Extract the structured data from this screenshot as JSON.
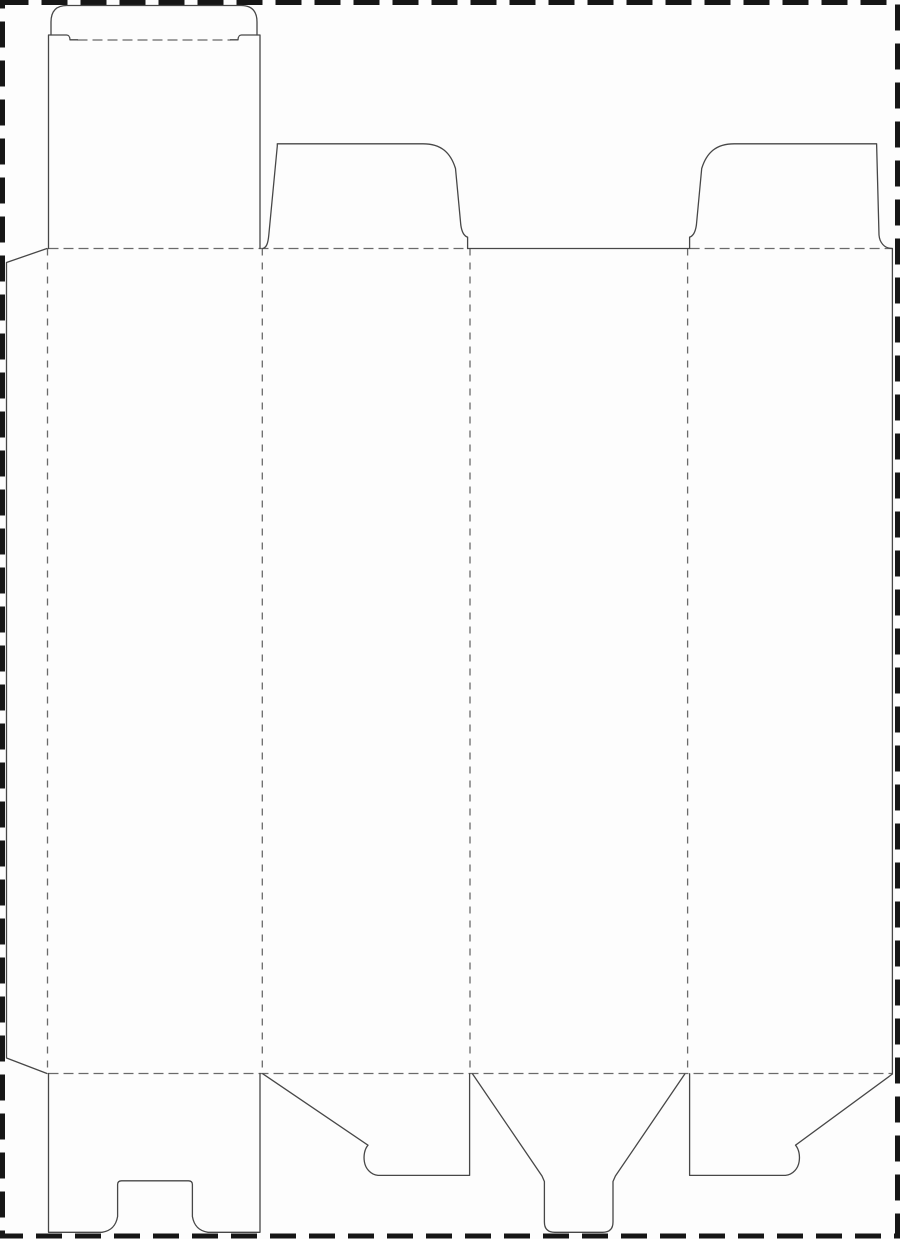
{
  "canvas": {
    "background": "#fdfdfd"
  },
  "colors": {
    "cut_line": "#474747",
    "fold_line": "#6a6a6a",
    "page_border": "#161616",
    "panel_fill": "#fdfdfd"
  },
  "dieline": {
    "page_border": "M2.5 2.5 L897.5 2.5 L897.5 1236 L2.5 1236 Z",
    "cuts": {
      "tuck_tongue": "M51 35 L51 22 Q51 5.5 67 5.5 L241 5.5 Q257 5.5 257 22 L257 35",
      "tuck_flap_left_edge": "M48.5 248.5 L48.5 35 L66.5 35 C69 35 69.8 36.5 70 39.8 L77.5 39.8",
      "tuck_flap_right_edge": "M260 248.5 L260 35 L241.5 35 C239 35 238.2 36.5 238 39.8 L230.5 39.8",
      "glue_flap": "M47 248.5 L6.5 262.5 L6.5 1058 L47 1073.5",
      "dust_flap_left": "M262.8 248.5 C266.5 247.5 268 243.5 268.8 235 L277.3 146 L277.3 143.8 L423 143.8 C441 143.8 450.5 152.5 455.5 168.5 L460.8 225 C461.8 232 464.2 236.1 467.6 237.1 L467.6 248.5",
      "dust_flap_right": "M689.6 248.5 L689.6 237.1 C693 236.1 695.4 232 696.4 225 L701.7 168.5 C706.7 152.5 716.2 143.8 734.2 143.8 L876.6 143.8 L879 235 C879.6 242 883.8 248.5 892.4 248.5",
      "back_panel_top_edge": "M467.6 248.5 L689.6 248.5",
      "right_panel_cut_edge": "M892.4 248.5 L892.4 1073.5",
      "bottom_flap_tuck_lock": "M48.5 1073.5 L48.5 1232.3 L102 1232.3 C111.5 1230.8 116 1225.5 117.6 1216.5 L117.6 1184.5 Q117.6 1180.8 121.6 1180.8 L188.4 1180.8 Q192.4 1180.8 192.4 1184.5 L192.4 1216.5 C194 1225.5 198.5 1230.8 208 1232.3 L260 1232.3 L260 1073.5",
      "bottom_dust_flap_left": "M262.8 1073.8 L368 1145.2 C364.5 1149.2 363.4 1155.8 364.4 1161.8 C365.4 1168 370 1174.4 378 1175.4 L469.6 1175.4 L469.6 1073.8",
      "bottom_tongue_flap": "M472.6 1074 L542 1176 L544.4 1181.5 L544.4 1222 Q544.4 1232.3 554.8 1232.3 L602.6 1232.3 Q613 1232.3 613 1222 L613 1181.5 L615.4 1176 L684.8 1074",
      "bottom_dust_flap_right": "M689.6 1073.8 L689.6 1175.4 L785.5 1175.4 C793.5 1174.4 798.1 1168 799.1 1161.8 C800.1 1155.8 799 1149.2 795.5 1145.2 L892.4 1074"
    },
    "folds": {
      "tuck_crease": "M77.5 40 L230.5 40",
      "top_fold_left_section": "M48.5 248.5 L467.6 248.5",
      "top_fold_right_section": "M689.6 248.5 L892.4 248.5",
      "bottom_fold": "M48.5 1073.5 L892.4 1073.5",
      "glue_flap_fold": "M47.5 248.5 L47.5 1073.5",
      "panel1_panel2_fold": "M262.3 248.5 L262.3 1073.5",
      "panel2_panel3_fold": "M470 248.5 L470 1073.5",
      "panel3_panel4_fold": "M687.6 248.5 L687.6 1073.5"
    }
  }
}
